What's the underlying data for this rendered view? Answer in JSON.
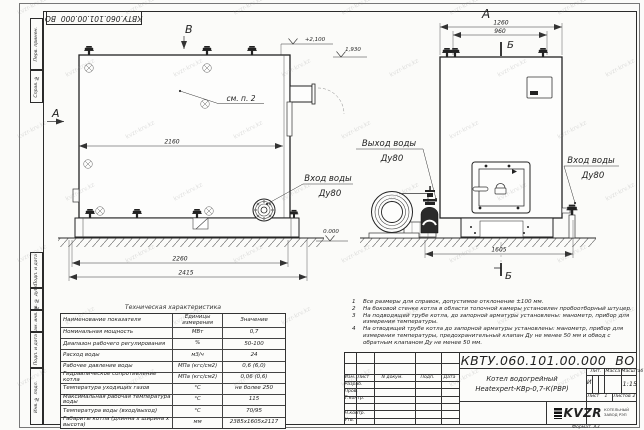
{
  "stamp": {
    "text": "КВТУ.060.101.00.000  ВО"
  },
  "margin_fields": [
    "Перв. примен.",
    "Справ. №",
    "Подп. и дата",
    "Инв. № дубл.",
    "Взам. инв. №",
    "Подп. и дата",
    "Инв. № подл."
  ],
  "drawing": {
    "view_labels": {
      "section_left": "А",
      "view_top": "В",
      "view_right_top": "А",
      "section_cut_top": "Б",
      "section_cut_bottom": "Б"
    },
    "note_ref": "см. п. 2",
    "elevations": {
      "top": "+2,100",
      "flue": "1,930",
      "zero": "0.000"
    },
    "dimensions": {
      "front_mid": "2160",
      "front_base": "2260",
      "front_total": "2415",
      "side_total": "1260",
      "side_inner": "960",
      "side_base": "1605"
    },
    "ports": {
      "outlet_label": "Выход воды",
      "outlet_dn": "Ду80",
      "inlet_label": "Вход воды",
      "inlet_dn": "Ду80",
      "inlet2_label": "Вход воды",
      "inlet2_dn": "Ду80"
    }
  },
  "tech_table": {
    "title": "Техническая характеристика",
    "headers": [
      "Наименование показателя",
      "Единицы измерения",
      "Значение"
    ],
    "rows": [
      [
        "Номинальная мощность",
        "МВт",
        "0,7"
      ],
      [
        "Диапазон рабочего регулирования",
        "%",
        "50-100"
      ],
      [
        "Расход воды",
        "м3/ч",
        "24"
      ],
      [
        "Рабочее давление воды",
        "МПа (кгс/см2)",
        "0,6 (6,0)"
      ],
      [
        "Гидравлическое сопротивление котла",
        "МПа (кгс/см2)",
        "0,06 (0,6)"
      ],
      [
        "Температура уходящих газов",
        "°С",
        "не более 250"
      ],
      [
        "Максимальная рабочая температура воды",
        "°С",
        "115"
      ],
      [
        "Температура воды (вход/выход)",
        "°С",
        "70/95"
      ],
      [
        "Габариты котла (длинна х ширина х высота)",
        "мм",
        "2385х1605х2117"
      ]
    ]
  },
  "notes": {
    "items": [
      {
        "num": "1",
        "text": "Все размеры для справок, допустимое отклонение ±100 мм."
      },
      {
        "num": "2",
        "text": "На боковой стенке котла в области топочной камеры установлен пробоотборный штуцер."
      },
      {
        "num": "3",
        "text": "На  подводящей трубе котла, до запорной арматуры установлены: манометр, прибор для измерения температуры."
      },
      {
        "num": "4",
        "text": "На отводящей трубе котла до запорной арматуры установлены: манометр, прибор для измерения температуры, предохранительный клапан Ду не менее 50 мм и обвод с обратным клапаном Ду не менее 50 мм."
      }
    ]
  },
  "title_block": {
    "doc_number": "КВТУ.060.101.00.000  ВО",
    "product_line1": "Котел водогрейный",
    "product_line2": "Heatexpert-КВр-0,7-К(РВР)",
    "rev_headers": [
      "Изм.",
      "Лист",
      "N докум.",
      "Подп.",
      "Дата"
    ],
    "sign_rows": [
      "Разраб.",
      "Пров.",
      "Т.контр.",
      "Н.контр.",
      "Утв."
    ],
    "lit_label": "Лит.",
    "mass_label": "Масса",
    "scale_label": "Масштаб",
    "lit_value": "И",
    "scale_value": "1:15",
    "sheet_label": "Лист",
    "sheet_value": "1",
    "sheets_label": "Листов",
    "sheets_value": "2",
    "logo_text": "KVZR",
    "logo_sub1": "КОТЕЛЬНЫЙ",
    "logo_sub2": "ЗАВОД РЭП",
    "format_label": "Формат  А3"
  },
  "watermark": {
    "text": "kvzr-krv.kz"
  }
}
